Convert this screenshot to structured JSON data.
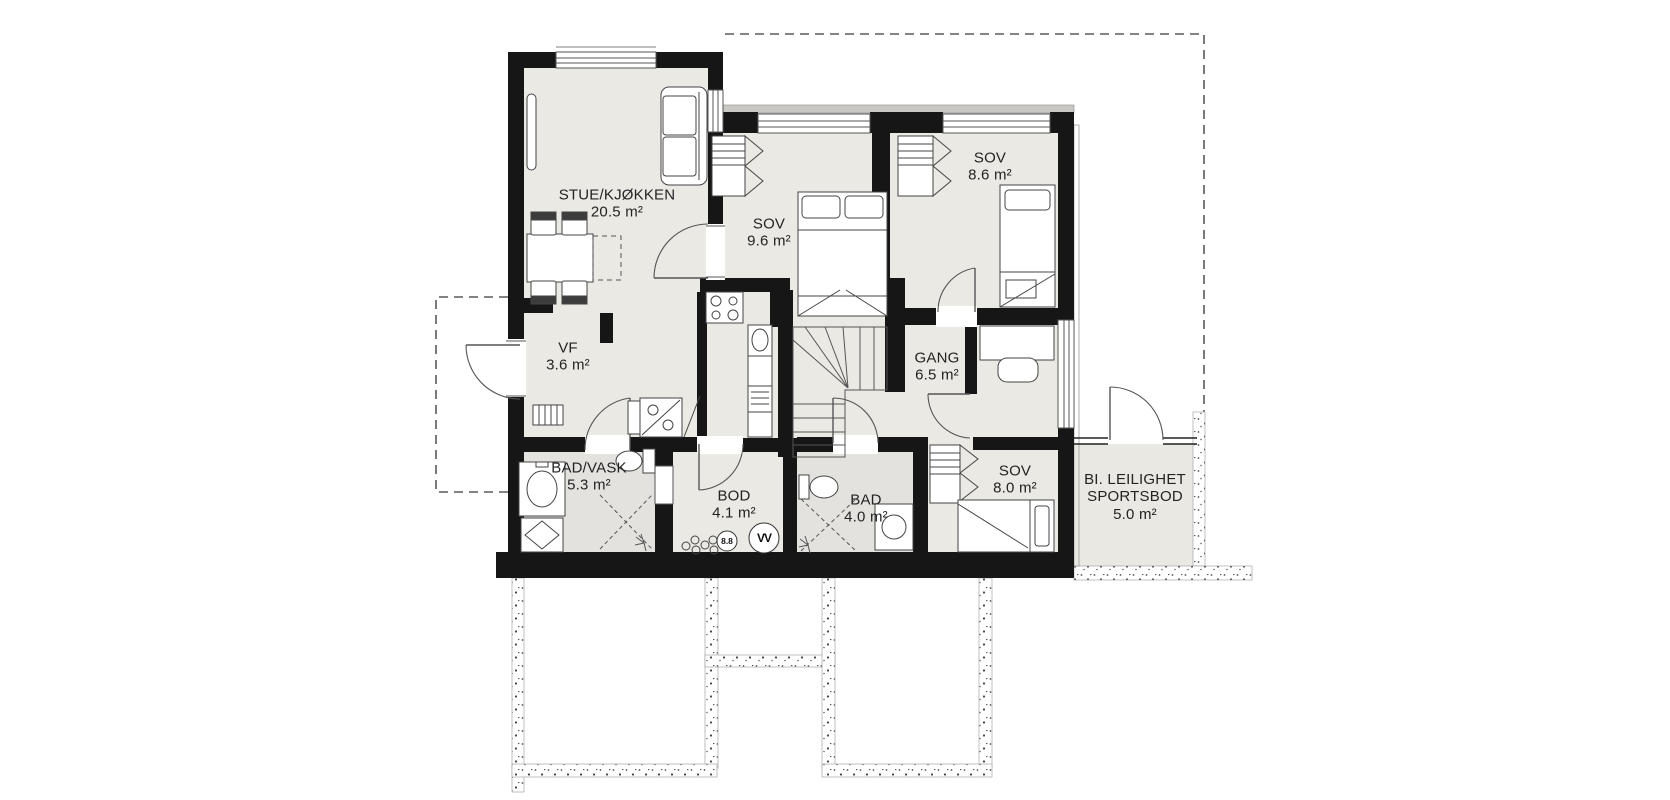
{
  "floorplan": {
    "rooms": [
      {
        "name": "STUE/KJØKKEN",
        "area": "20.5 m²"
      },
      {
        "name": "SOV",
        "area": "9.6 m²"
      },
      {
        "name": "SOV",
        "area": "8.6 m²"
      },
      {
        "name": "VF",
        "area": "3.6 m²"
      },
      {
        "name": "GANG",
        "area": "6.5 m²"
      },
      {
        "name": "BAD/VASK",
        "area": "5.3 m²"
      },
      {
        "name": "BOD",
        "area": "4.1 m²"
      },
      {
        "name": "BAD",
        "area": "4.0 m²"
      },
      {
        "name": "SOV",
        "area": "8.0 m²"
      },
      {
        "name": "BI. LEILIGHET",
        "name_line2": "SPORTSBOD",
        "area": "5.0 m²"
      }
    ],
    "symbols": {
      "water_heater": "VV",
      "manifold": "8.8"
    },
    "colors": {
      "wall": "#161616",
      "floor": "#ebe9e3",
      "wet_floor": "#e3e2df",
      "outline": "#4b4b4b",
      "window_sill": "#c9c8c4",
      "dash": "#5a5a5a"
    }
  }
}
